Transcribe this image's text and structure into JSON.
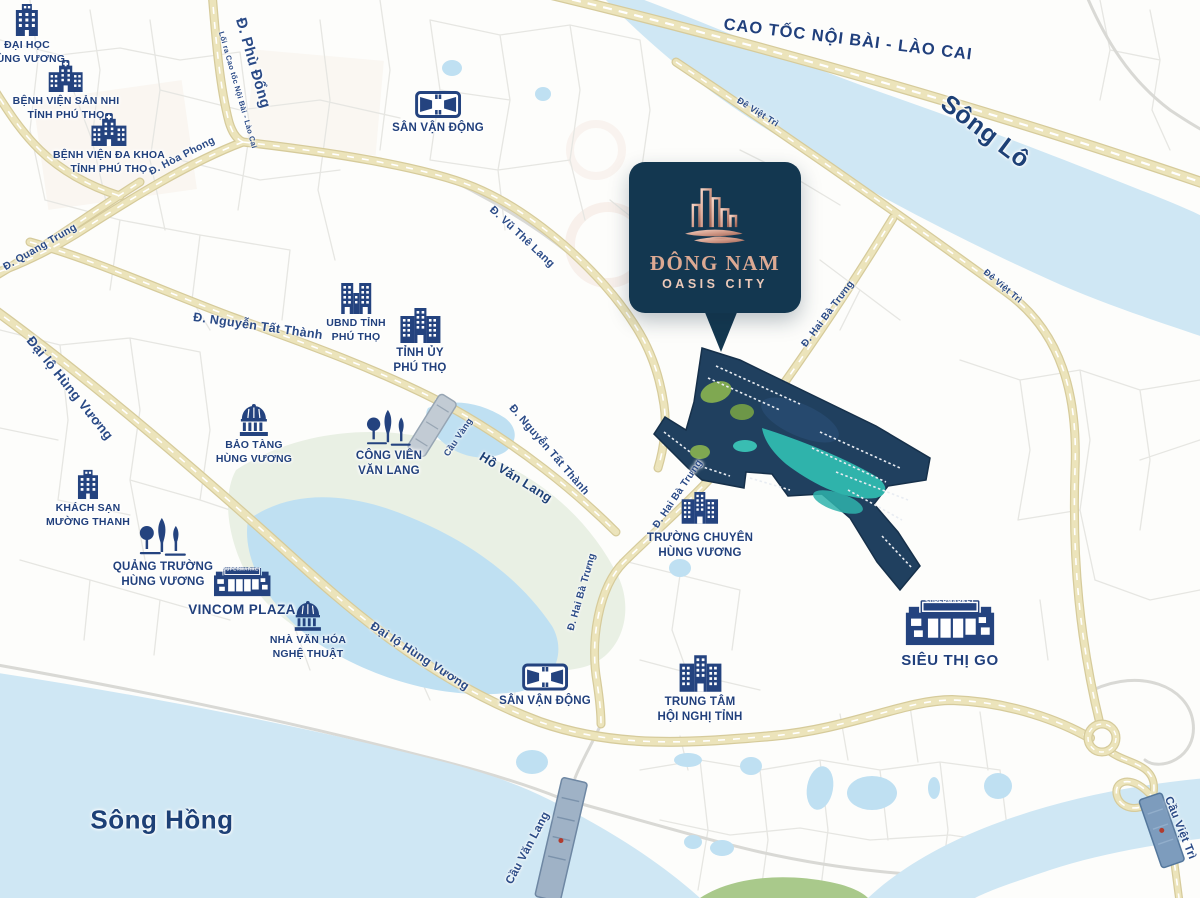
{
  "brand": {
    "title": "ĐÔNG NAM",
    "subtitle": "OASIS CITY"
  },
  "map": {
    "roads": [
      {
        "text": "CAO TỐC NỘI BÀI - LÀO CAI"
      },
      {
        "text": "Đ. Phù Đổng"
      },
      {
        "text": "Lối ra Cao tốc Nội Bài - Lào Cai"
      },
      {
        "text": "Đ. Hòa Phong"
      },
      {
        "text": "Đ. Quang Trung"
      },
      {
        "text": "Đ. Vũ Thê Lang"
      },
      {
        "text": "Đ. Nguyễn Tất Thành"
      },
      {
        "text": "Đ. Nguyễn Tất Thành"
      },
      {
        "text": "Đại lộ Hùng Vương"
      },
      {
        "text": "Đại lộ Hùng Vương"
      },
      {
        "text": "Đ. Hai Bà Trưng"
      },
      {
        "text": "Đ. Hai Bà Trưng"
      },
      {
        "text": "Đ. Hai Bà Trưng"
      },
      {
        "text": "Đê Việt Trì"
      },
      {
        "text": "Đê Việt Trì"
      }
    ],
    "bridges": [
      {
        "text": "Cầu Vàng"
      },
      {
        "text": "Cầu Văn Lang"
      },
      {
        "text": "Cầu Việt Trì"
      }
    ],
    "waters": [
      {
        "text": "Sông Lô"
      },
      {
        "text": "Sông Hồng"
      },
      {
        "text": "Hồ Văn Lang"
      }
    ],
    "landmarks": [
      {
        "id": "dai-hoc-hung-vuong",
        "line1": "ĐẠI HỌC",
        "line2": "HÙNG VƯƠNG"
      },
      {
        "id": "benh-vien-san-nhi",
        "line1": "BỆNH VIỆN SẢN NHI",
        "line2": "TỈNH PHÚ THỌ"
      },
      {
        "id": "benh-vien-da-khoa",
        "line1": "BỆNH VIỆN ĐA KHOA",
        "line2": "TỈNH PHÚ THỌ"
      },
      {
        "id": "san-van-dong-bac",
        "line1": "SÂN VẬN ĐỘNG"
      },
      {
        "id": "ubnd-tinh",
        "line1": "UBND TỈNH",
        "line2": "PHÚ THỌ"
      },
      {
        "id": "tinh-uy",
        "line1": "TỈNH ỦY",
        "line2": "PHÚ THỌ"
      },
      {
        "id": "bao-tang",
        "line1": "BẢO TÀNG",
        "line2": "HÙNG VƯƠNG"
      },
      {
        "id": "cong-vien-van-lang",
        "line1": "CÔNG VIÊN",
        "line2": "VĂN LANG"
      },
      {
        "id": "khach-san-muong-thanh",
        "line1": "KHÁCH SẠN",
        "line2": "MƯỜNG THANH"
      },
      {
        "id": "quang-truong",
        "line1": "QUẢNG TRƯỜNG",
        "line2": "HÙNG VƯƠNG"
      },
      {
        "id": "vincom-plaza",
        "line1": "VINCOM PLAZA",
        "icon_text": "SUPERMARKET"
      },
      {
        "id": "nha-van-hoa",
        "line1": "NHÀ VĂN HÓA",
        "line2": "NGHỆ THUẬT"
      },
      {
        "id": "truong-chuyen",
        "line1": "TRƯỜNG CHUYÊN",
        "line2": "HÙNG VƯƠNG"
      },
      {
        "id": "san-van-dong-nam",
        "line1": "SÂN VẬN ĐỘNG"
      },
      {
        "id": "trung-tam-hoi-nghi",
        "line1": "TRUNG TÂM",
        "line2": "HỘI NGHỊ TỈNH"
      },
      {
        "id": "sieu-thi-go",
        "line1": "SIÊU THỊ GO",
        "icon_text": "SUPERMARKET"
      }
    ]
  },
  "colors": {
    "label_navy": "#21407c",
    "icon_navy": "#24437f",
    "road_yellow_fill": "#ece4bb",
    "road_yellow_casing": "#d6cb9b",
    "river_blue": "#cfe7f4",
    "lake_blue": "#bfe0f2",
    "marsh_green": "#e9f0e4",
    "card_background": "#133750",
    "logo_copper": "#dca993",
    "site_navy": "#20405f",
    "site_teal": "#2fb3ab"
  }
}
